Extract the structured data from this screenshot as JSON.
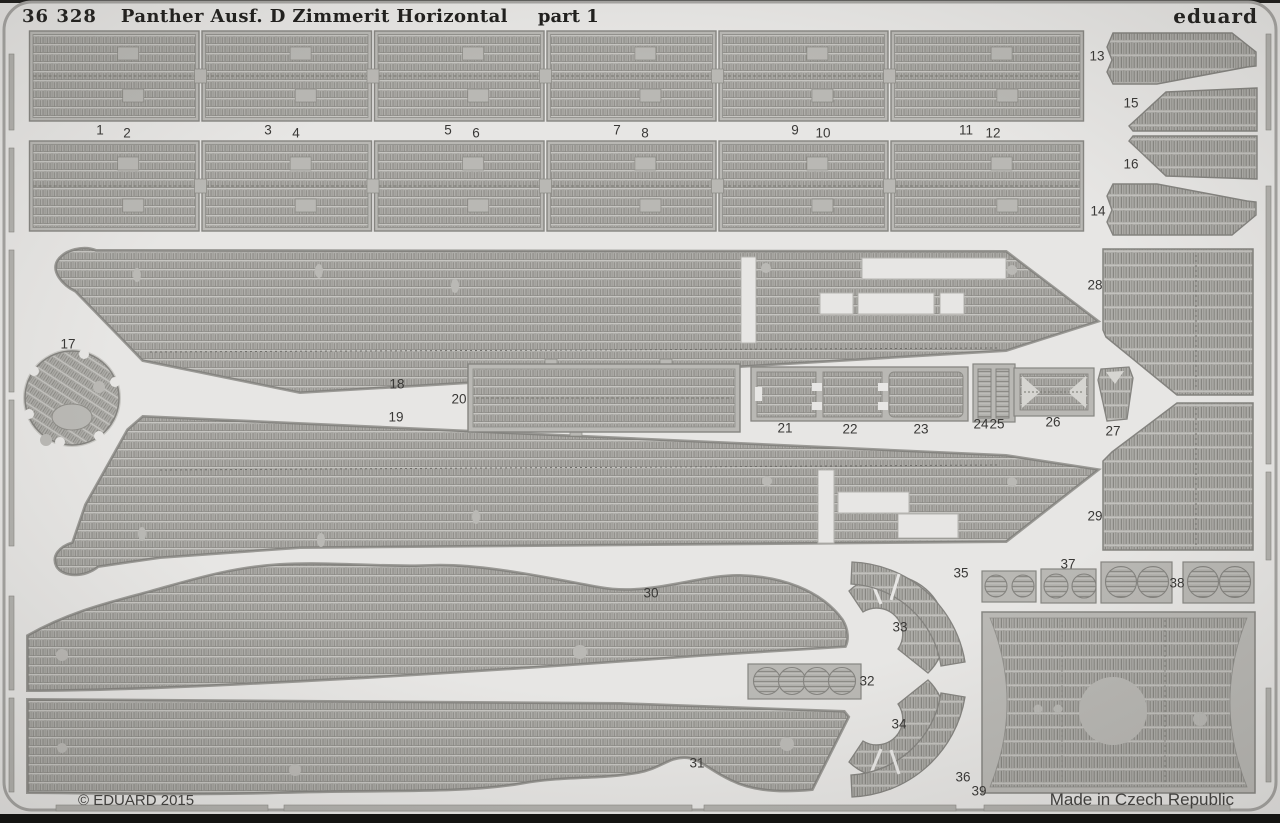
{
  "header": {
    "catalog_number": "36 328",
    "title": "Panther Ausf. D Zimmerit Horizontal",
    "part_label": "part 1",
    "brand": "eduard"
  },
  "footer": {
    "copyright": "© EDUARD 2015",
    "origin": "Made in Czech Republic"
  },
  "colors": {
    "background": "#e7e6e4",
    "metal_plate": "#b9b8b4",
    "metal_texture_base": "#b0afab",
    "etch_dark": "#84837f",
    "frame": "#a5a4a1",
    "edge_black": "#1a1a18",
    "text": "#393836"
  },
  "parts": [
    {
      "num": "1",
      "x": 100,
      "y": 130
    },
    {
      "num": "2",
      "x": 127,
      "y": 133
    },
    {
      "num": "3",
      "x": 268,
      "y": 130
    },
    {
      "num": "4",
      "x": 296,
      "y": 133
    },
    {
      "num": "5",
      "x": 448,
      "y": 130
    },
    {
      "num": "6",
      "x": 476,
      "y": 133
    },
    {
      "num": "7",
      "x": 617,
      "y": 130
    },
    {
      "num": "8",
      "x": 645,
      "y": 133
    },
    {
      "num": "9",
      "x": 795,
      "y": 130
    },
    {
      "num": "10",
      "x": 823,
      "y": 133
    },
    {
      "num": "11",
      "x": 966,
      "y": 130
    },
    {
      "num": "12",
      "x": 993,
      "y": 133
    },
    {
      "num": "13",
      "x": 1097,
      "y": 56
    },
    {
      "num": "14",
      "x": 1098,
      "y": 211
    },
    {
      "num": "15",
      "x": 1131,
      "y": 103
    },
    {
      "num": "16",
      "x": 1131,
      "y": 164
    },
    {
      "num": "17",
      "x": 68,
      "y": 344
    },
    {
      "num": "18",
      "x": 397,
      "y": 384
    },
    {
      "num": "19",
      "x": 396,
      "y": 417
    },
    {
      "num": "20",
      "x": 459,
      "y": 399
    },
    {
      "num": "21",
      "x": 785,
      "y": 428
    },
    {
      "num": "22",
      "x": 850,
      "y": 429
    },
    {
      "num": "23",
      "x": 921,
      "y": 429
    },
    {
      "num": "24",
      "x": 981,
      "y": 424
    },
    {
      "num": "25",
      "x": 997,
      "y": 424
    },
    {
      "num": "26",
      "x": 1053,
      "y": 422
    },
    {
      "num": "27",
      "x": 1113,
      "y": 431
    },
    {
      "num": "28",
      "x": 1095,
      "y": 285
    },
    {
      "num": "29",
      "x": 1095,
      "y": 516
    },
    {
      "num": "30",
      "x": 651,
      "y": 593
    },
    {
      "num": "31",
      "x": 697,
      "y": 763
    },
    {
      "num": "32",
      "x": 867,
      "y": 681
    },
    {
      "num": "33",
      "x": 900,
      "y": 627
    },
    {
      "num": "34",
      "x": 899,
      "y": 724
    },
    {
      "num": "35",
      "x": 961,
      "y": 573
    },
    {
      "num": "36",
      "x": 963,
      "y": 777
    },
    {
      "num": "37",
      "x": 1068,
      "y": 564
    },
    {
      "num": "38",
      "x": 1177,
      "y": 583
    },
    {
      "num": "39",
      "x": 979,
      "y": 791
    }
  ]
}
